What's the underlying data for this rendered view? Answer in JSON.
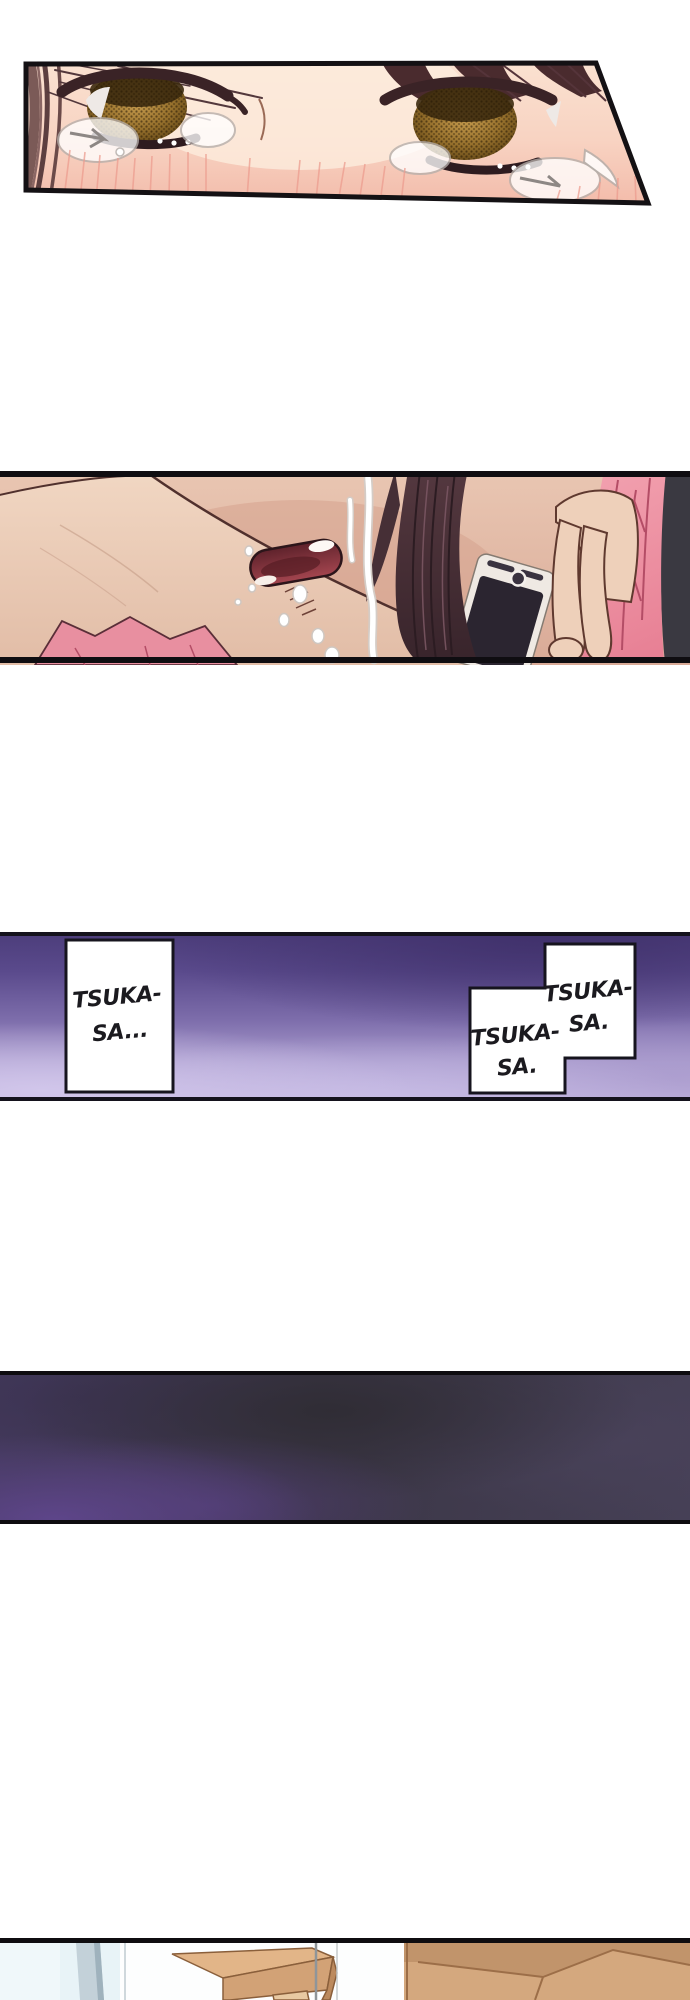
{
  "page": {
    "type": "manga-page",
    "background": "#ffffff",
    "border_color": "#14121c"
  },
  "bubbles": {
    "left": {
      "line1": "TSUKA-",
      "line2": "SA..."
    },
    "right_upper": {
      "line1": "TSUKA-",
      "line2": "SA."
    },
    "right_lower": {
      "line1": "TSUKA-",
      "line2": "SA."
    }
  },
  "panels": [
    {
      "id": "panel-1",
      "alt": "close-up of teary eyes"
    },
    {
      "id": "panel-2",
      "alt": "crying face holding phone to ear"
    },
    {
      "id": "panel-3",
      "alt": "purple gradient with speech boxes"
    },
    {
      "id": "panel-4",
      "alt": "dark smoky gradient"
    },
    {
      "id": "panel-5",
      "alt": "room interior, partially cut off"
    }
  ],
  "colors": {
    "skin_light": "#fae1d0",
    "skin_pink": "#f5c3b1",
    "iris_amber": "#a87f35",
    "hair_maroon": "#5d3a3c",
    "hair_dark_brown": "#3a262c",
    "mouth_red": "#a4454f",
    "sleeve_pink": "#ee93a2",
    "phone_screen": "#2b2530",
    "purple_dark": "#4d3e7c",
    "purple_light": "#c2b5e0",
    "smoke_violet": "#5f468c",
    "wall_blue": "#e8f3f7",
    "box_tan": "#dcae80"
  }
}
